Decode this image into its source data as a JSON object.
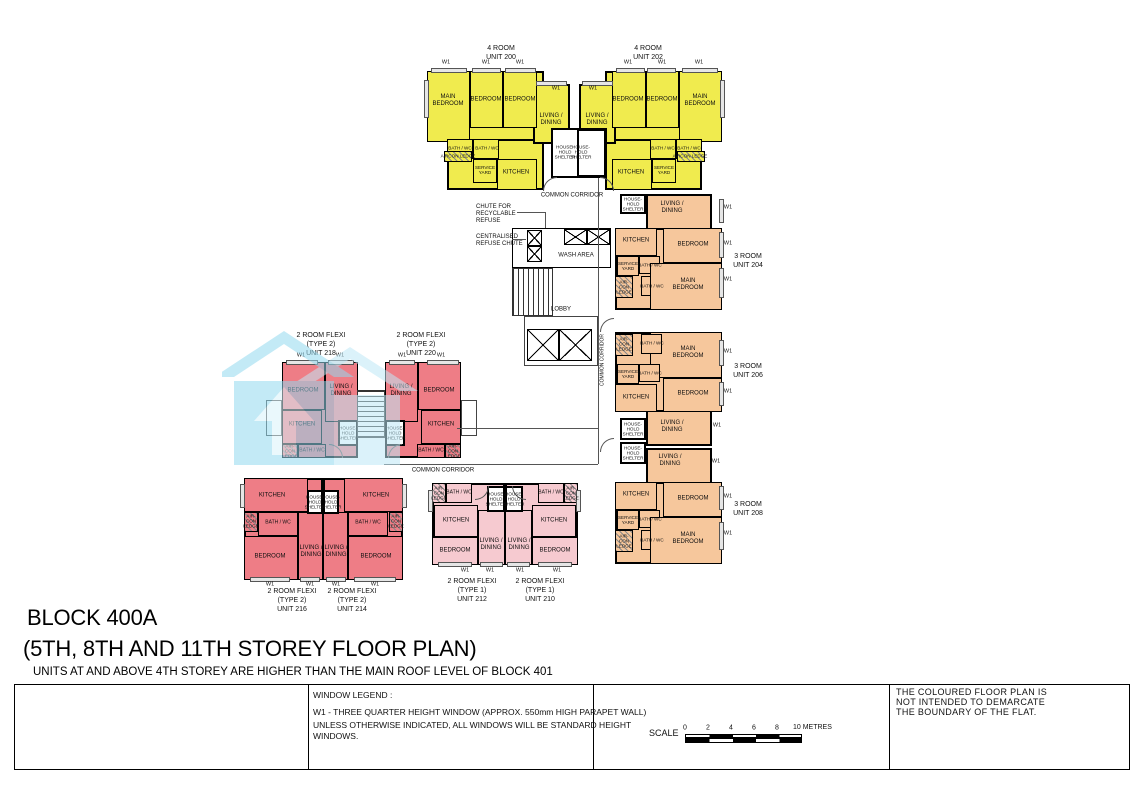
{
  "drawing": {
    "title_block": "BLOCK 400A",
    "title_storey": "(5TH, 8TH AND 11TH STOREY FLOOR PLAN)",
    "title_note": "UNITS AT AND ABOVE 4TH STOREY ARE HIGHER THAN THE MAIN ROOF LEVEL OF BLOCK 401"
  },
  "rooms": {
    "main_bedroom": "MAIN\nBEDROOM",
    "bedroom": "BEDROOM",
    "living_dining": "LIVING /\nDINING",
    "kitchen": "KITCHEN",
    "bath_wc": "BATH / WC",
    "service_yard": "SERVICE\nYARD",
    "aircon_ledge": "AIRCON LEDGE",
    "aircon_ledge_small": "AIR-\nCON\nLEDGE",
    "household_shelter": "HOUSE-\nHOLD\nSHELTER",
    "w1": "W1"
  },
  "core": {
    "common_corridor": "COMMON CORRIDOR",
    "wash_area": "WASH AREA",
    "lobby": "LOBBY",
    "chute_recyclable": "CHUTE FOR\nRECYCLABLE\nREFUSE",
    "chute_centralised": "CENTRALISED\nREFUSE CHUTE"
  },
  "units": {
    "u200": "4 ROOM\nUNIT 200",
    "u202": "4 ROOM\nUNIT 202",
    "u204": "3 ROOM\nUNIT 204",
    "u206": "3 ROOM\nUNIT 206",
    "u208": "3 ROOM\nUNIT 208",
    "u210": "2 ROOM FLEXI\n(TYPE 1)\nUNIT 210",
    "u212": "2 ROOM FLEXI\n(TYPE 1)\nUNIT 212",
    "u214": "2 ROOM FLEXI\n(TYPE 2)\nUNIT 214",
    "u216": "2 ROOM FLEXI\n(TYPE 2)\nUNIT 216",
    "u218": "2 ROOM FLEXI\n(TYPE 2)\nUNIT 218",
    "u220": "2 ROOM FLEXI\n(TYPE 2)\nUNIT 220"
  },
  "window_legend": {
    "heading": "WINDOW LEGEND :",
    "w1_line": "W1  - THREE QUARTER HEIGHT WINDOW (APPROX. 550mm HIGH PARAPET WALL)",
    "note": "UNLESS OTHERWISE INDICATED, ALL WINDOWS WILL BE STANDARD HEIGHT\nWINDOWS."
  },
  "scale_bar": {
    "label": "SCALE",
    "ticks": [
      "0",
      "2",
      "4",
      "6",
      "8"
    ],
    "end_label": "10 METRES"
  },
  "disclaimer": "THE COLOURED FLOOR PLAN IS\nNOT INTENDED TO DEMARCATE\nTHE BOUNDARY OF THE FLAT.",
  "colors": {
    "four_room": "#f0eb4e",
    "three_room": "#f6c79c",
    "two_room_flexi_type2": "#ee7d86",
    "two_room_flexi_type1": "#f6cad0",
    "watermark_blue": "#93d9ef"
  }
}
